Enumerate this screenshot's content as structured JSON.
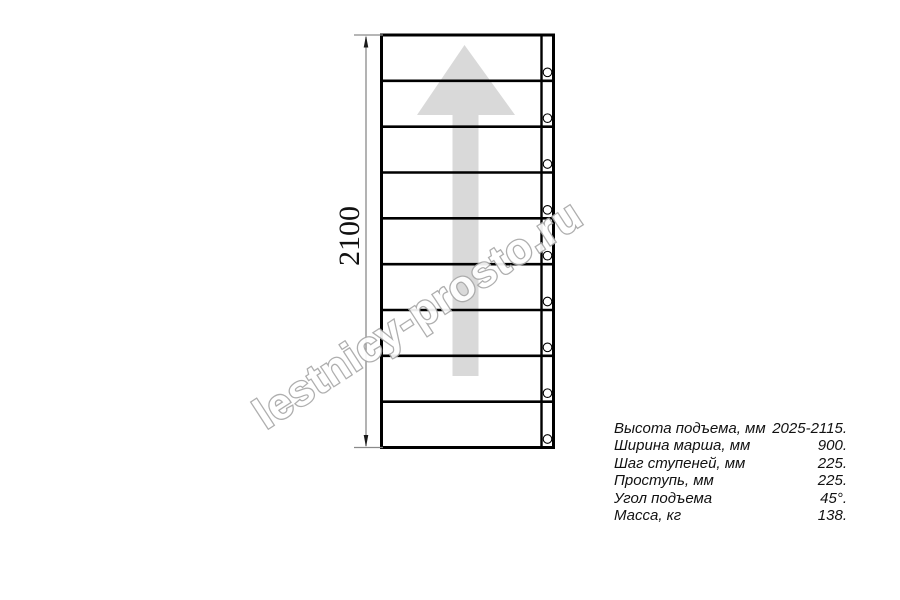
{
  "diagram": {
    "dimension_label": "2100",
    "steps_count": 9,
    "screw_count": 9,
    "arrow_direction": "up",
    "watermark_text": "lestnicy-prosto.ru",
    "colors": {
      "line": "#000000",
      "arrow_fill": "#d9d9d9",
      "watermark_outline": "#a8a8a8",
      "dimension_line": "#8a8a8a",
      "text": "#111111"
    }
  },
  "specs_table": {
    "rows": [
      {
        "label": "Высота подъема, мм",
        "value": "2025-2115."
      },
      {
        "label": "Ширина марша, мм",
        "value": "900."
      },
      {
        "label": "Шаг ступеней, мм",
        "value": "225."
      },
      {
        "label": "Проступь, мм",
        "value": "225."
      },
      {
        "label": "Угол подъема",
        "value": "45°."
      },
      {
        "label": "Масса, кг",
        "value": "138."
      }
    ]
  }
}
